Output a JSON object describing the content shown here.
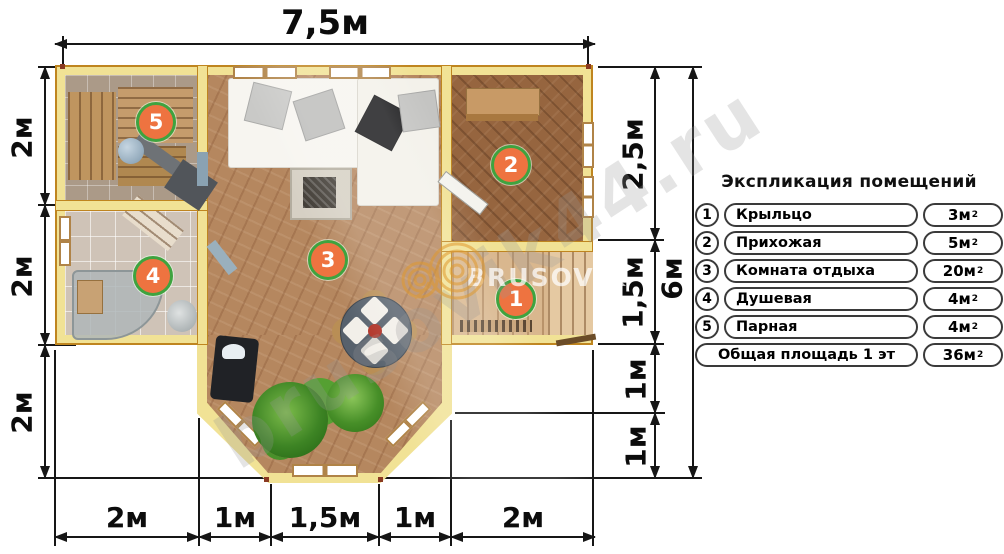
{
  "dimensions": {
    "top": "7,5м",
    "left": [
      "2м",
      "2м",
      "2м"
    ],
    "right": [
      "2,5м",
      "1,5м",
      "1м",
      "1м"
    ],
    "right_total": "6м",
    "bottom": [
      "2м",
      "1м",
      "1,5м",
      "1м",
      "2м"
    ]
  },
  "legend": {
    "title": "Экспликация помещений",
    "rows": [
      {
        "num": "1",
        "name": "Крыльцо",
        "area": "3м",
        "sup": "2"
      },
      {
        "num": "2",
        "name": "Прихожая",
        "area": "5м",
        "sup": "2"
      },
      {
        "num": "3",
        "name": "Комната отдыха",
        "area": "20м",
        "sup": "2"
      },
      {
        "num": "4",
        "name": "Душевая",
        "area": "4м",
        "sup": "2"
      },
      {
        "num": "5",
        "name": "Парная",
        "area": "4м",
        "sup": "2"
      }
    ],
    "total": {
      "name": "Общая площадь 1 эт",
      "area": "36м",
      "sup": "2"
    }
  },
  "plan_markers": [
    {
      "num": "1"
    },
    {
      "num": "2"
    },
    {
      "num": "3"
    },
    {
      "num": "4"
    },
    {
      "num": "5"
    }
  ],
  "watermarks": {
    "diagonal": "brusovik44.ru",
    "brand": "BRUSOVIK"
  },
  "colors": {
    "marker_fill": "#ee7340",
    "marker_ring": "#3fa33f",
    "wall": "#f1e295",
    "wall_edge": "#bf851f"
  }
}
